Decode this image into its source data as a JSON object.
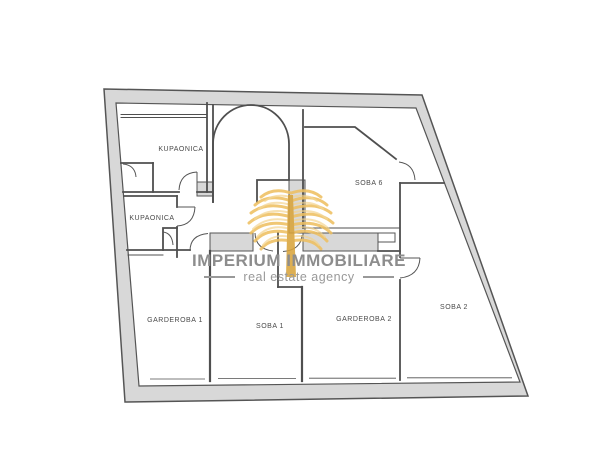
{
  "watermark": {
    "title": "IMPERIUM IMMOBILIARE",
    "subtitle": "real estate agency"
  },
  "floorplan": {
    "rooms": [
      {
        "id": "kupaonica-upper",
        "label": "KUPAONICA"
      },
      {
        "id": "kupaonica-lower",
        "label": "KUPAONICA"
      },
      {
        "id": "soba-6",
        "label": "SOBA 6"
      },
      {
        "id": "garderoba-1",
        "label": "GARDEROBA 1"
      },
      {
        "id": "soba-1",
        "label": "SOBA 1"
      },
      {
        "id": "garderoba-2",
        "label": "GARDEROBA 2"
      },
      {
        "id": "soba-2",
        "label": "SOBA 2"
      }
    ]
  },
  "colors": {
    "background": "#ffffff",
    "wall_fill": "#d8d8d8",
    "wall_line": "#4f4f4f",
    "label_text": "#4a4a4a",
    "watermark_text": "#8d8d8d",
    "logo_gold": "#eec061",
    "logo_trunk": "#d9a43c"
  }
}
